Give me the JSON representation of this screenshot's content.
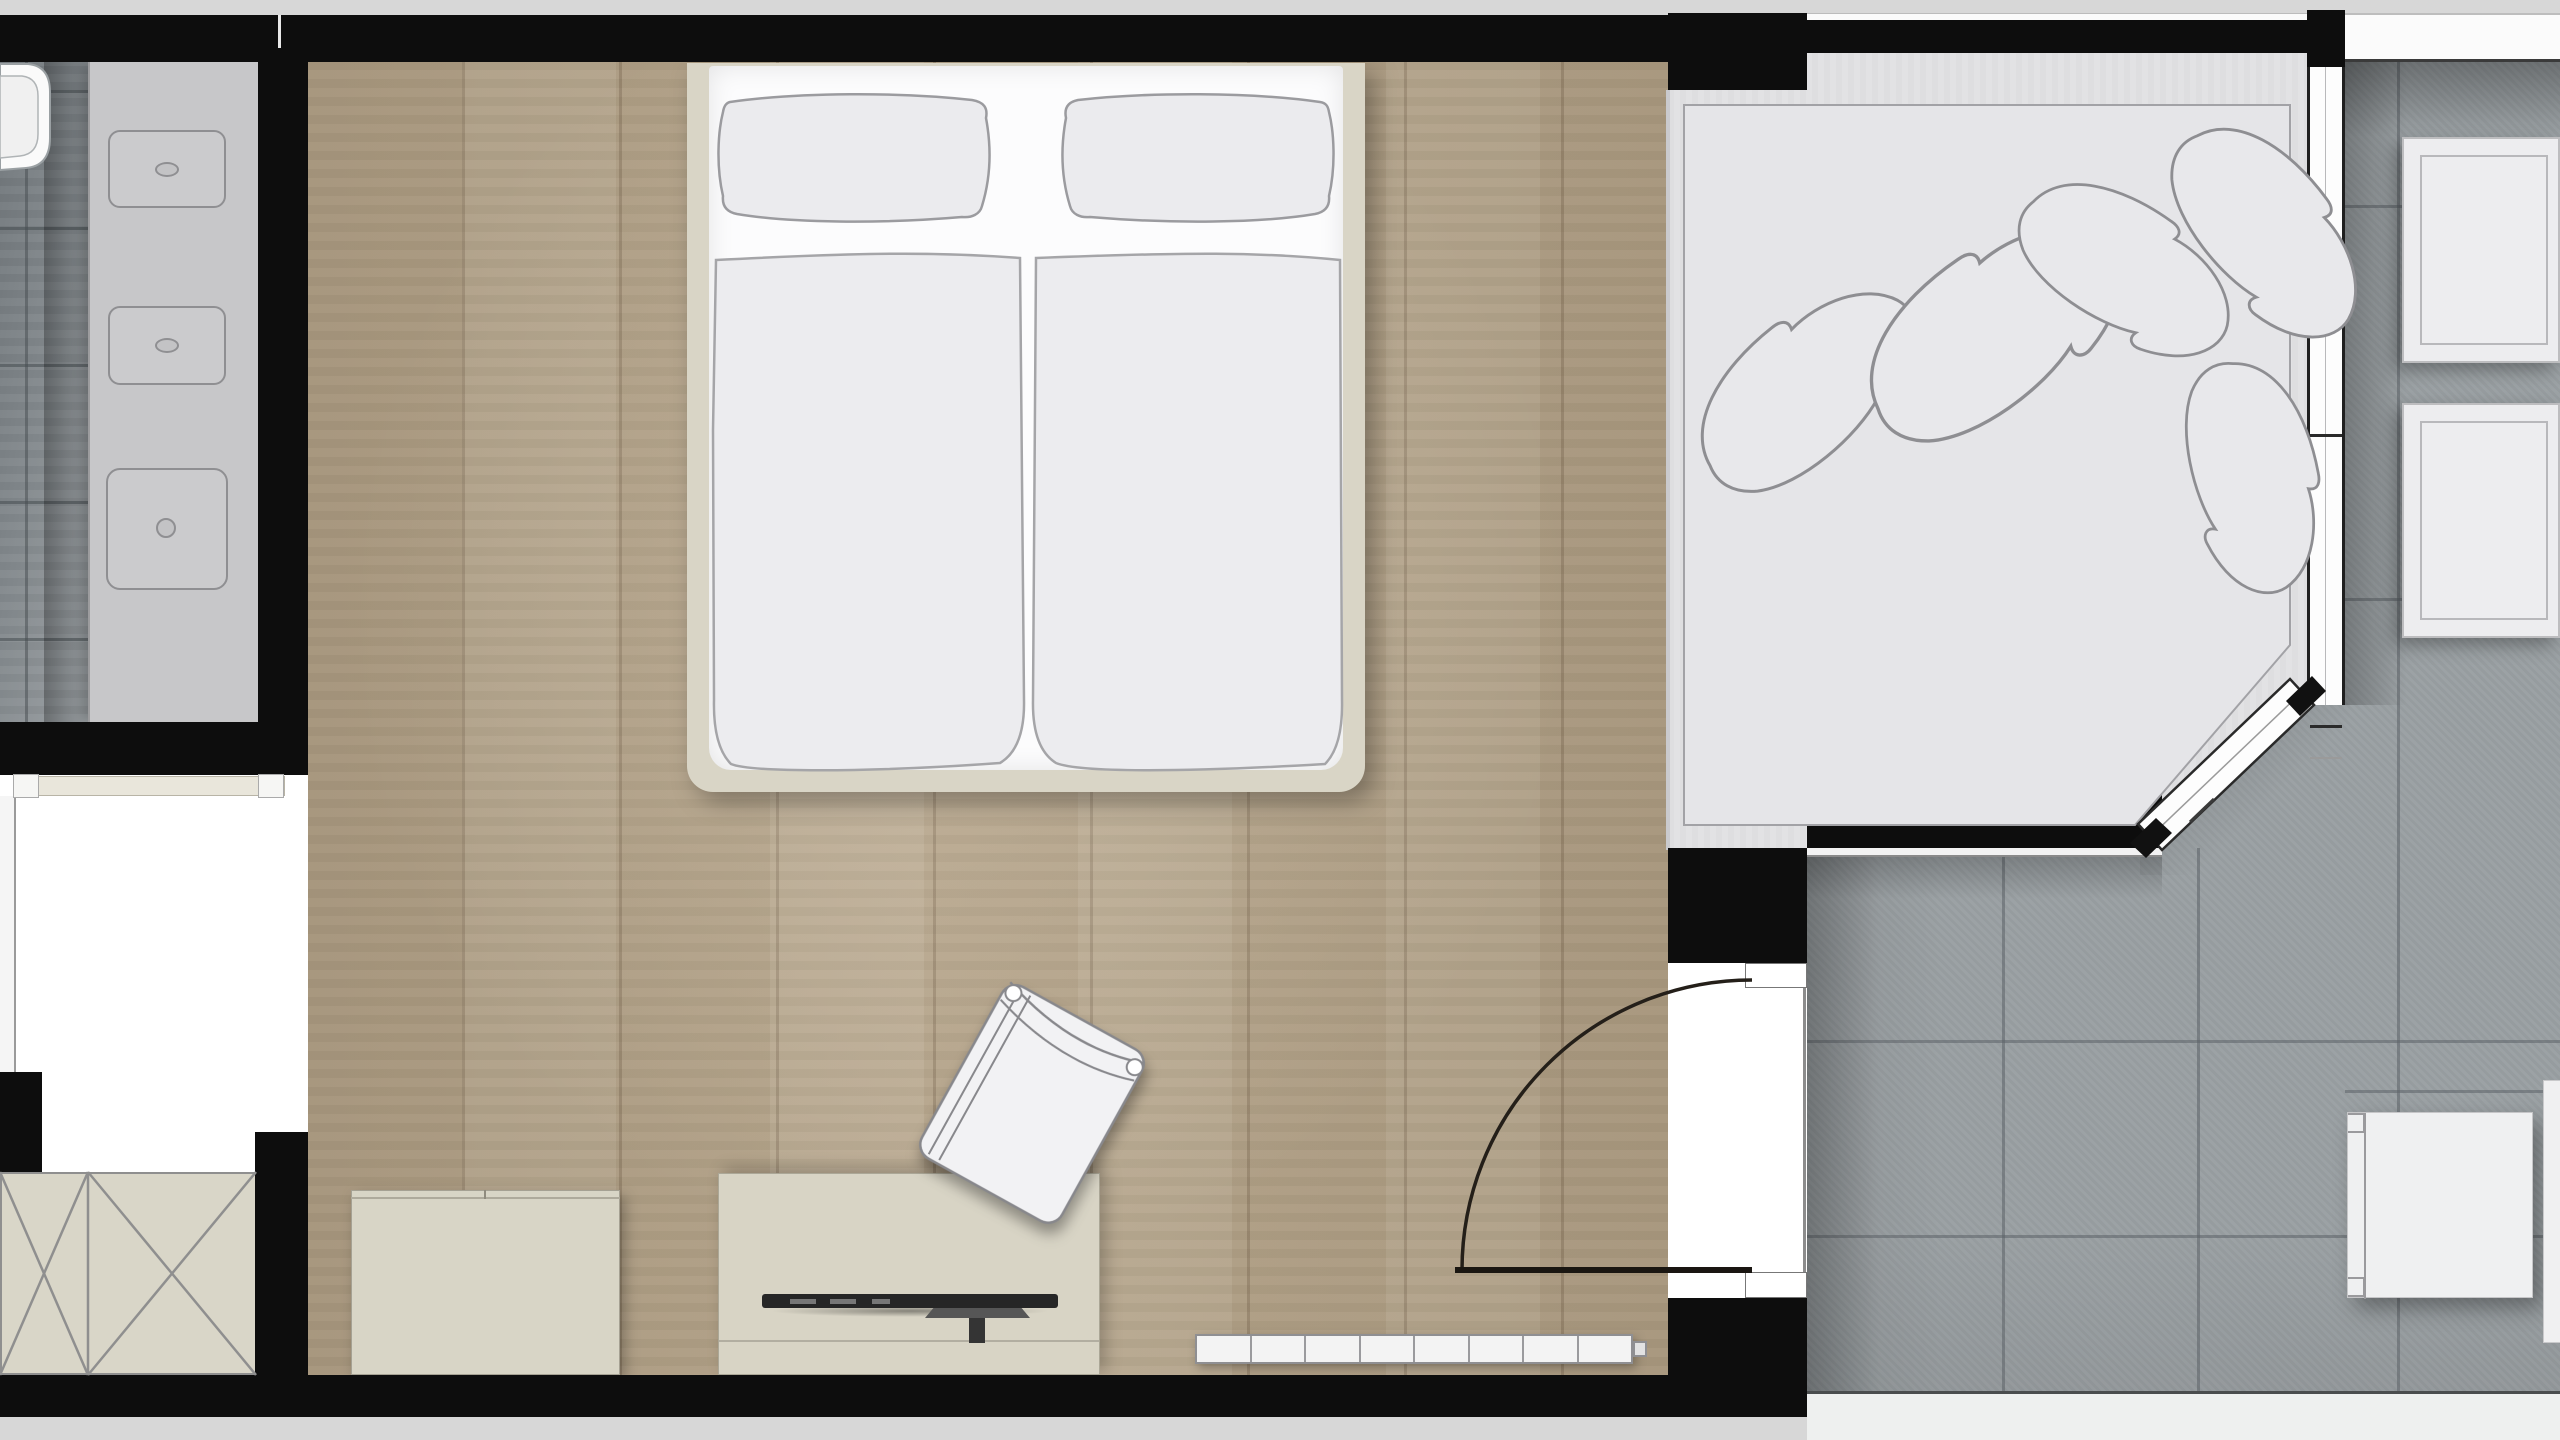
{
  "document": {
    "type": "floor-plan",
    "view": "top-down architectural plan of a hotel room suite",
    "visible_text": ""
  },
  "colors": {
    "wall": "#0d0d0d",
    "outside": "#d7d7d7",
    "wood_floor": "#b3a287",
    "bath_tile_dark": "#70767a",
    "bath_tile_light": "#b6babc",
    "terrace_tile": "#9aa0a3",
    "grout": "#5c6367",
    "conservatory_floor": "#e2e2e4",
    "furniture_cream": "#d8d4c5",
    "bed_frame": "#d9d5c6",
    "linen_white": "#fcfcfd",
    "linen_gray": "#ebebee",
    "outline_gray": "#9a9a9e",
    "window_white": "#fdfdfd",
    "tv_dark": "#262626"
  },
  "rooms": [
    {
      "id": "bathroom",
      "name": "bathroom",
      "floor": "gray ceramic tile"
    },
    {
      "id": "bedroom",
      "name": "bedroom",
      "floor": "oak plank"
    },
    {
      "id": "conservatory",
      "name": "lounge platform area",
      "floor": "light gray"
    },
    {
      "id": "terrace",
      "name": "terrace",
      "floor": "large gray tile"
    }
  ],
  "fixtures": {
    "bathroom": {
      "vanity_basins": 2,
      "square_basin": 1,
      "toilet": 1
    },
    "bedroom": {
      "double_bed": {
        "pillows": 2,
        "duvets": 2
      },
      "nightstands": 2,
      "wardrobe_door_panels": 2,
      "cabinet": 1,
      "tv_sideboard": 1,
      "television": 1,
      "chair": 1,
      "radiator_segments": 8
    },
    "conservatory": {
      "platform": 1,
      "throw_pillows": 5
    },
    "terrace": {
      "lounge_cushions": 2,
      "outdoor_chair": 1,
      "side_table_partial": 1
    }
  },
  "architecture": {
    "door": {
      "type": "single swing",
      "swings_into": "bedroom",
      "wall": "bedroom-terrace"
    },
    "windows": [
      "right facade window band",
      "diagonal bay window",
      "top terrace railing band",
      "left edge window strip"
    ],
    "bath_grout_rows": [
      90,
      227,
      364,
      501,
      638
    ],
    "terrace_grout_v_low": [
      2002,
      2197,
      2397
    ],
    "terrace_grout_h_low": [
      1040,
      1235
    ],
    "terrace_grout_v_high": [
      2397
    ],
    "terrace_grout_h_high": [
      205,
      598,
      1090
    ],
    "tv_dashes": [
      [
        790,
        26
      ],
      [
        830,
        26
      ],
      [
        872,
        18
      ]
    ]
  }
}
